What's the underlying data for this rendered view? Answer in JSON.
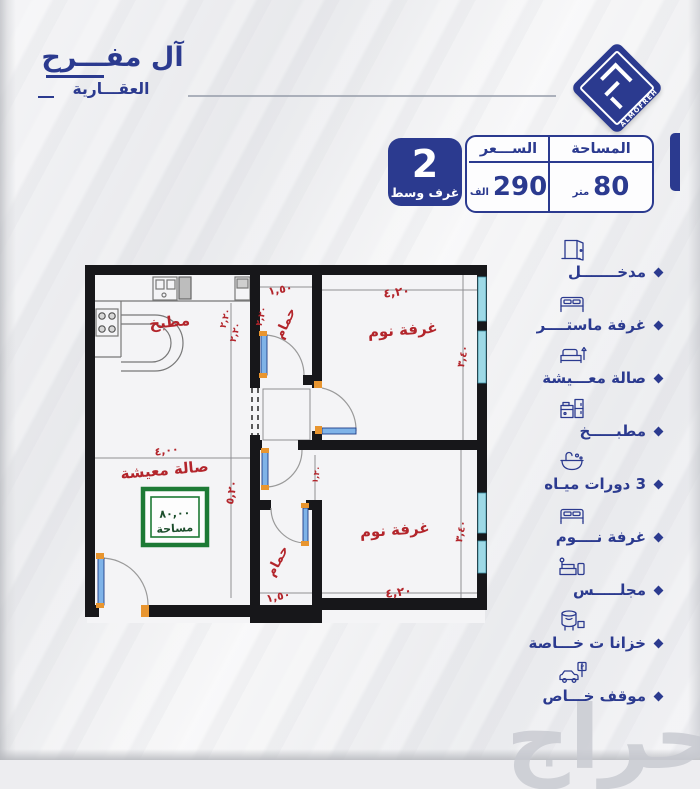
{
  "brand": {
    "name_line1": "آل مفـــرح",
    "name_line2": "العقـــارية",
    "logo_text": "ALMOFREH"
  },
  "info": {
    "badge": {
      "number": "2",
      "label": "غرف وسط"
    },
    "price": {
      "header": "الســـعر",
      "value": "290",
      "unit": "الف"
    },
    "area": {
      "header": "المساحة",
      "value": "80",
      "unit": "متر"
    }
  },
  "legend": {
    "parking_letter": "P",
    "items": [
      {
        "icon": "door-icon",
        "label": "مدخـــــــل"
      },
      {
        "icon": "bed-icon",
        "label": "غرفة ماستــــر"
      },
      {
        "icon": "living-icon",
        "label": "صالة معـــيشة"
      },
      {
        "icon": "kitchen-icon",
        "label": "مطبـــــخ"
      },
      {
        "icon": "bath-icon",
        "label": "3 دورات ميـاه"
      },
      {
        "icon": "bed-icon",
        "label": "غرفة نــــوم"
      },
      {
        "icon": "majlis-icon",
        "label": "مجلـــــس"
      },
      {
        "icon": "tanks-icon",
        "label": "خزانا ت خـــاصة"
      },
      {
        "icon": "parking-icon",
        "label": "موقف خـــاص"
      }
    ]
  },
  "floorplan": {
    "rooms": {
      "kitchen": "مطبخ",
      "living_room": "صالة معيشة",
      "bathroom": "حمام",
      "bedroom": "غرفة نوم"
    },
    "area_box": {
      "value": "٨٠,٠٠",
      "label": "مساحة"
    },
    "dims": {
      "w_bath": "١,٥٠",
      "w_bedroom": "٤,٢٠",
      "h_bath": "٢,٢٠",
      "h_bedroom": "٣,٤٠",
      "w_living": "٤,٠٠",
      "h_living": "٥,٢٠",
      "w_corridor": "١,٢٠"
    }
  },
  "watermark": "حراج",
  "colors": {
    "primary": "#2b3a8f",
    "dim_red": "#b3252b",
    "area_green": "#1d7a35",
    "wall": "#17171a",
    "window": "#9ed9e6",
    "door_leaf": "#7fb3e8",
    "hinge": "#e8952f",
    "watermark": "#c7c9d0"
  }
}
